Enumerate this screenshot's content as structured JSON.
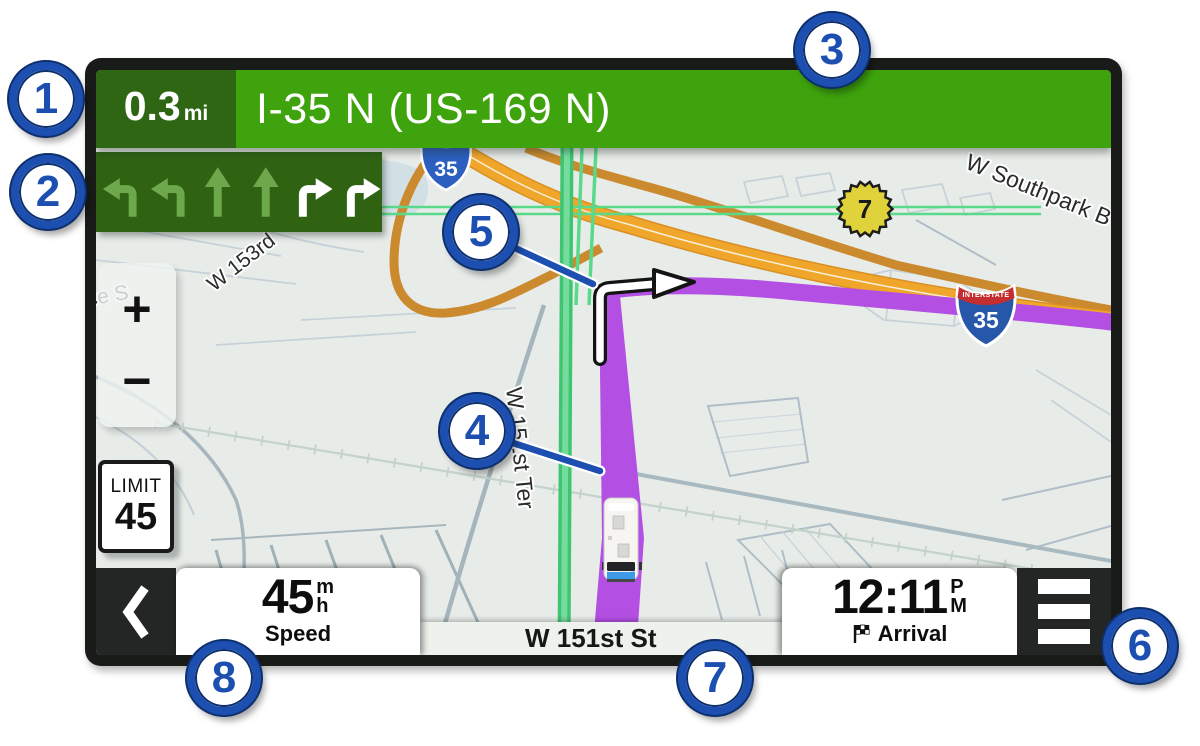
{
  "nav_bar": {
    "distance_value": "0.3",
    "distance_unit": "mi",
    "instruction": "I-35 N (US-169 N)"
  },
  "lane_guidance": {
    "lanes": [
      {
        "direction": "turn-left",
        "active": false
      },
      {
        "direction": "turn-left",
        "active": false
      },
      {
        "direction": "straight",
        "active": false
      },
      {
        "direction": "straight",
        "active": false
      },
      {
        "direction": "turn-right",
        "active": true
      },
      {
        "direction": "turn-right",
        "active": true
      }
    ]
  },
  "map": {
    "street_labels": {
      "southpark": "W Southpark B",
      "w_153rd": "W 153rd",
      "w_151st_ter": "W 151st Ter",
      "ce_st": "ce S"
    },
    "shields": {
      "highway_top_number": "35",
      "interstate_word": "INTERSTATE",
      "interstate_number": "35",
      "route_7": "7"
    },
    "speed_limit": {
      "label": "LIMIT",
      "value": "45"
    },
    "zoom_in": "+",
    "zoom_out": "−"
  },
  "bottom_bar": {
    "speed": {
      "value": "45",
      "unit_top": "m",
      "unit_bottom": "h",
      "label": "Speed"
    },
    "street": "W 151st St",
    "arrival": {
      "time": "12:11",
      "ampm_top": "P",
      "ampm_bottom": "M",
      "label": "Arrival"
    }
  },
  "callouts": {
    "c1": "1",
    "c2": "2",
    "c3": "3",
    "c4": "4",
    "c5": "5",
    "c6": "6",
    "c7": "7",
    "c8": "8"
  },
  "colors": {
    "accent_green": "#3ea30d",
    "dark_green": "#2e6613",
    "route_purple": "#b44fe3",
    "road_orange": "#f0a62a",
    "callout_blue": "#1c4fb0"
  }
}
